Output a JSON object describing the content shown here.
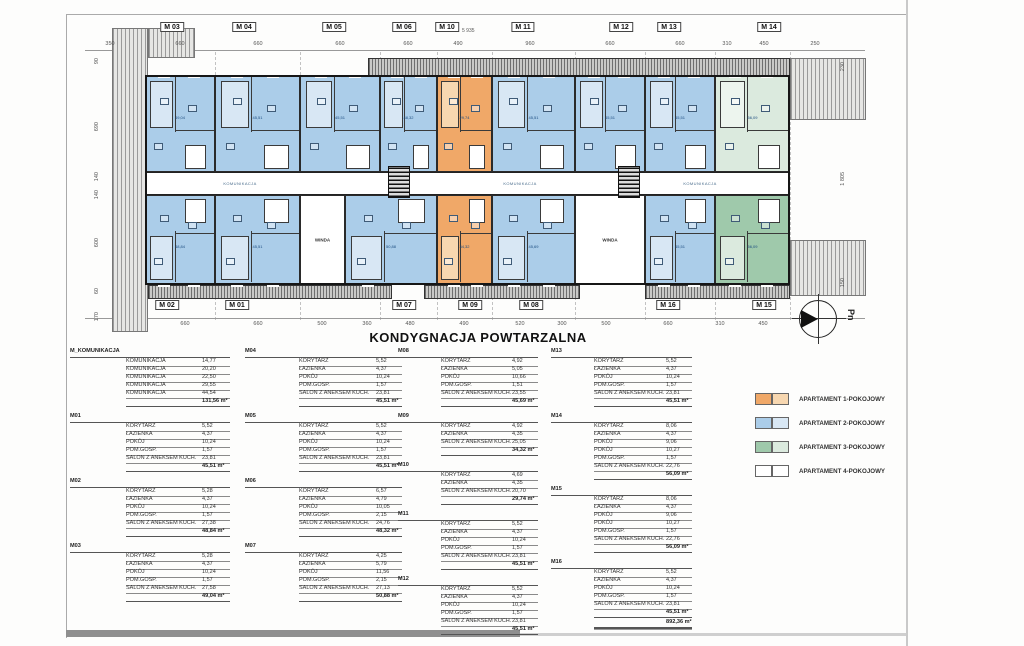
{
  "title": "KONDYGNACJA POWTARZALNA",
  "north_label": "Pn",
  "plan": {
    "corridor_label": "KOMUNIKACJA",
    "elevator_label": "WINDA",
    "level_note": "5 935",
    "top_labels": [
      {
        "t": "M 03",
        "x": 172
      },
      {
        "t": "M 04",
        "x": 244
      },
      {
        "t": "M 05",
        "x": 334
      },
      {
        "t": "M 06",
        "x": 404
      },
      {
        "t": "M 10",
        "x": 447
      },
      {
        "t": "M 11",
        "x": 523
      },
      {
        "t": "M 12",
        "x": 621
      },
      {
        "t": "M 13",
        "x": 669
      },
      {
        "t": "M 14",
        "x": 769
      }
    ],
    "bottom_labels": [
      {
        "t": "M 02",
        "x": 167
      },
      {
        "t": "M 01",
        "x": 237
      },
      {
        "t": "M 07",
        "x": 404
      },
      {
        "t": "M 09",
        "x": 470
      },
      {
        "t": "M 08",
        "x": 531
      },
      {
        "t": "M 16",
        "x": 668
      },
      {
        "t": "M 15",
        "x": 764
      }
    ],
    "top_dims": [
      {
        "t": "350",
        "x": 110
      },
      {
        "t": "660",
        "x": 180
      },
      {
        "t": "660",
        "x": 258
      },
      {
        "t": "660",
        "x": 340
      },
      {
        "t": "660",
        "x": 408
      },
      {
        "t": "490",
        "x": 458
      },
      {
        "t": "960",
        "x": 530
      },
      {
        "t": "660",
        "x": 610
      },
      {
        "t": "660",
        "x": 680
      },
      {
        "t": "310",
        "x": 727
      },
      {
        "t": "450",
        "x": 764
      },
      {
        "t": "250",
        "x": 815
      }
    ],
    "bottom_dims": [
      {
        "t": "660",
        "x": 185
      },
      {
        "t": "660",
        "x": 258
      },
      {
        "t": "500",
        "x": 322
      },
      {
        "t": "360",
        "x": 367
      },
      {
        "t": "480",
        "x": 410
      },
      {
        "t": "490",
        "x": 464
      },
      {
        "t": "520",
        "x": 520
      },
      {
        "t": "300",
        "x": 562
      },
      {
        "t": "500",
        "x": 606
      },
      {
        "t": "660",
        "x": 668
      },
      {
        "t": "310",
        "x": 720
      },
      {
        "t": "450",
        "x": 763
      }
    ],
    "left_dims": [
      {
        "t": "90",
        "y": 58
      },
      {
        "t": "690",
        "y": 122
      },
      {
        "t": "140",
        "y": 172
      },
      {
        "t": "140",
        "y": 190
      },
      {
        "t": "600",
        "y": 238
      },
      {
        "t": "60",
        "y": 288
      },
      {
        "t": "170",
        "y": 312
      }
    ],
    "right_dims": [
      {
        "t": "230",
        "y": 62
      },
      {
        "t": "1 805",
        "y": 172
      },
      {
        "t": "150",
        "y": 278
      }
    ],
    "apartments": [
      {
        "id": "M 03",
        "row": "top",
        "x": 145,
        "w": 70,
        "type": "2",
        "area": "49,04"
      },
      {
        "id": "M 04",
        "row": "top",
        "x": 215,
        "w": 85,
        "type": "2",
        "area": "45,51"
      },
      {
        "id": "M 05",
        "row": "top",
        "x": 300,
        "w": 80,
        "type": "2",
        "area": "45,51"
      },
      {
        "id": "M 06",
        "row": "top",
        "x": 380,
        "w": 57,
        "type": "2",
        "area": "48,32"
      },
      {
        "id": "M 10",
        "row": "top",
        "x": 437,
        "w": 55,
        "type": "1",
        "area": "29,74"
      },
      {
        "id": "M 11",
        "row": "top",
        "x": 492,
        "w": 83,
        "type": "2",
        "area": "45,51"
      },
      {
        "id": "M 12",
        "row": "top",
        "x": 575,
        "w": 70,
        "type": "2",
        "area": "45,51"
      },
      {
        "id": "M 13",
        "row": "top",
        "x": 645,
        "w": 70,
        "type": "2",
        "area": "45,51"
      },
      {
        "id": "M 14",
        "row": "top",
        "x": 715,
        "w": 75,
        "type": "3l",
        "area": "56,09"
      },
      {
        "id": "M 02",
        "row": "bottom",
        "x": 145,
        "w": 70,
        "type": "2",
        "area": "48,84"
      },
      {
        "id": "M 01",
        "row": "bottom",
        "x": 215,
        "w": 85,
        "type": "2",
        "area": "45,51"
      },
      {
        "id": "CORE A",
        "row": "bottom",
        "x": 300,
        "w": 45,
        "type": "core",
        "area": ""
      },
      {
        "id": "M 07",
        "row": "bottom",
        "x": 345,
        "w": 92,
        "type": "2",
        "area": "50,88"
      },
      {
        "id": "M 09",
        "row": "bottom",
        "x": 437,
        "w": 55,
        "type": "1",
        "area": "34,32"
      },
      {
        "id": "M 08",
        "row": "bottom",
        "x": 492,
        "w": 83,
        "type": "2",
        "area": "45,69"
      },
      {
        "id": "CORE B",
        "row": "bottom",
        "x": 575,
        "w": 70,
        "type": "core",
        "area": ""
      },
      {
        "id": "M 16",
        "row": "bottom",
        "x": 645,
        "w": 70,
        "type": "2",
        "area": "45,51"
      },
      {
        "id": "M 15",
        "row": "bottom",
        "x": 715,
        "w": 75,
        "type": "3",
        "area": "56,09"
      }
    ]
  },
  "colors": {
    "ap1": "#f0a868",
    "ap1l": "#f7d7b0",
    "ap2": "#abcde9",
    "ap2l": "#d8e7f4",
    "ap3": "#9fc9ab",
    "ap3l": "#dbeade",
    "core": "#ffffff",
    "corel": "#f4f4f4",
    "wall": "#1b1b1b"
  },
  "legend": {
    "items": [
      {
        "label": "APARTAMENT 1-POKOJOWY",
        "main": "#f0a868",
        "light": "#f7d7b0"
      },
      {
        "label": "APARTAMENT 2-POKOJOWY",
        "main": "#abcde9",
        "light": "#d8e7f4"
      },
      {
        "label": "APARTAMENT 3-POKOJOWY",
        "main": "#9fc9ab",
        "light": "#dbeade"
      },
      {
        "label": "APARTAMENT 4-POKOJOWY",
        "main": "#ffffff",
        "light": "#ffffff"
      }
    ]
  },
  "tables": {
    "unit_suffix": "m²",
    "columns": [
      [
        {
          "id": "M_KOMUNIKACJA",
          "rows": [
            [
              "KOMUNIKACJA",
              "14,77"
            ],
            [
              "KOMUNIKACJA",
              "20,20"
            ],
            [
              "KOMUNIKACJA",
              "22,50"
            ],
            [
              "KOMUNIKACJA",
              "29,55"
            ],
            [
              "KOMUNIKACJA",
              "44,54"
            ]
          ],
          "total": "131,56 m²"
        },
        {
          "id": "M01",
          "rows": [
            [
              "KORYTARZ",
              "5,52"
            ],
            [
              "ŁAZIENKA",
              "4,37"
            ],
            [
              "POKÓJ",
              "10,24"
            ],
            [
              "POM.GOSP.",
              "1,57"
            ],
            [
              "SALON Z ANEKSEM KUCH.",
              "23,81"
            ]
          ],
          "total": "45,51 m²"
        },
        {
          "id": "M02",
          "rows": [
            [
              "KORYTARZ",
              "5,28"
            ],
            [
              "ŁAZIENKA",
              "4,37"
            ],
            [
              "POKÓJ",
              "10,24"
            ],
            [
              "POM.GOSP.",
              "1,57"
            ],
            [
              "SALON Z ANEKSEM KUCH.",
              "27,38"
            ]
          ],
          "total": "48,84 m²"
        },
        {
          "id": "M03",
          "rows": [
            [
              "KORYTARZ",
              "5,28"
            ],
            [
              "ŁAZIENKA",
              "4,37"
            ],
            [
              "POKÓJ",
              "10,24"
            ],
            [
              "POM.GOSP.",
              "1,57"
            ],
            [
              "SALON Z ANEKSEM KUCH.",
              "27,58"
            ]
          ],
          "total": "49,04 m²"
        }
      ],
      [
        {
          "id": "M04",
          "rows": [
            [
              "KORYTARZ",
              "5,52"
            ],
            [
              "ŁAZIENKA",
              "4,37"
            ],
            [
              "POKÓJ",
              "10,24"
            ],
            [
              "POM.GOSP.",
              "1,57"
            ],
            [
              "SALON Z ANEKSEM KUCH.",
              "23,81"
            ]
          ],
          "total": "45,51 m²"
        },
        {
          "id": "M05",
          "rows": [
            [
              "KORYTARZ",
              "5,52"
            ],
            [
              "ŁAZIENKA",
              "4,37"
            ],
            [
              "POKÓJ",
              "10,24"
            ],
            [
              "POM.GOSP.",
              "1,57"
            ],
            [
              "SALON Z ANEKSEM KUCH.",
              "23,81"
            ]
          ],
          "total": "45,51 m²"
        },
        {
          "id": "M06",
          "rows": [
            [
              "KORYTARZ",
              "6,57"
            ],
            [
              "ŁAZIENKA",
              "4,79"
            ],
            [
              "POKÓJ",
              "10,05"
            ],
            [
              "POM.GOSP.",
              "2,15"
            ],
            [
              "SALON Z ANEKSEM KUCH.",
              "24,76"
            ]
          ],
          "total": "48,32 m²"
        },
        {
          "id": "M07",
          "rows": [
            [
              "KORYTARZ",
              "4,25"
            ],
            [
              "ŁAZIENKA",
              "5,79"
            ],
            [
              "POKÓJ",
              "11,56"
            ],
            [
              "POM.GOSP.",
              "2,15"
            ],
            [
              "SALON Z ANEKSEM KUCH.",
              "27,13"
            ]
          ],
          "total": "50,88 m²"
        }
      ],
      [
        {
          "id": "M08",
          "rows": [
            [
              "KORYTARZ",
              "4,92"
            ],
            [
              "ŁAZIENKA",
              "5,05"
            ],
            [
              "POKÓJ",
              "10,66"
            ],
            [
              "POM.GOSP.",
              "1,51"
            ],
            [
              "SALON Z ANEKSEM KUCH.",
              "23,55"
            ]
          ],
          "total": "45,69 m²"
        },
        {
          "id": "M09",
          "rows": [
            [
              "KORYTARZ",
              "4,92"
            ],
            [
              "ŁAZIENKA",
              "4,35"
            ],
            [
              "SALON Z ANEKSEM KUCH.",
              "25,05"
            ]
          ],
          "total": "34,32 m²"
        },
        {
          "id": "M10",
          "rows": [
            [
              "KORYTARZ",
              "4,69"
            ],
            [
              "ŁAZIENKA",
              "4,35"
            ],
            [
              "SALON Z ANEKSEM KUCH.",
              "20,70"
            ]
          ],
          "total": "29,74 m²"
        },
        {
          "id": "M11",
          "rows": [
            [
              "KORYTARZ",
              "5,52"
            ],
            [
              "ŁAZIENKA",
              "4,37"
            ],
            [
              "POKÓJ",
              "10,24"
            ],
            [
              "POM.GOSP.",
              "1,57"
            ],
            [
              "SALON Z ANEKSEM KUCH.",
              "23,81"
            ]
          ],
          "total": "45,51 m²"
        },
        {
          "id": "M12",
          "rows": [
            [
              "KORYTARZ",
              "5,52"
            ],
            [
              "ŁAZIENKA",
              "4,37"
            ],
            [
              "POKÓJ",
              "10,24"
            ],
            [
              "POM.GOSP.",
              "1,57"
            ],
            [
              "SALON Z ANEKSEM KUCH.",
              "23,81"
            ]
          ],
          "total": "45,51 m²"
        }
      ],
      [
        {
          "id": "M13",
          "rows": [
            [
              "KORYTARZ",
              "5,52"
            ],
            [
              "ŁAZIENKA",
              "4,37"
            ],
            [
              "POKÓJ",
              "10,24"
            ],
            [
              "POM.GOSP.",
              "1,57"
            ],
            [
              "SALON Z ANEKSEM KUCH.",
              "23,81"
            ]
          ],
          "total": "45,51 m²"
        },
        {
          "id": "M14",
          "rows": [
            [
              "KORYTARZ",
              "8,06"
            ],
            [
              "ŁAZIENKA",
              "4,37"
            ],
            [
              "POKÓJ",
              "9,06"
            ],
            [
              "POKÓJ",
              "10,27"
            ],
            [
              "POM.GOSP.",
              "1,57"
            ],
            [
              "SALON Z ANEKSEM KUCH.",
              "22,76"
            ]
          ],
          "total": "56,09 m²"
        },
        {
          "id": "M15",
          "rows": [
            [
              "KORYTARZ",
              "8,06"
            ],
            [
              "ŁAZIENKA",
              "4,37"
            ],
            [
              "POKÓJ",
              "9,06"
            ],
            [
              "POKÓJ",
              "10,27"
            ],
            [
              "POM.GOSP.",
              "1,57"
            ],
            [
              "SALON Z ANEKSEM KUCH.",
              "22,76"
            ]
          ],
          "total": "56,09 m²"
        },
        {
          "id": "M16",
          "rows": [
            [
              "KORYTARZ",
              "5,52"
            ],
            [
              "ŁAZIENKA",
              "4,37"
            ],
            [
              "POKÓJ",
              "10,24"
            ],
            [
              "POM.GOSP.",
              "1,57"
            ],
            [
              "SALON Z ANEKSEM KUCH.",
              "23,81"
            ]
          ],
          "total": "45,51 m²",
          "grand_total": "892,36 m²"
        }
      ]
    ]
  }
}
